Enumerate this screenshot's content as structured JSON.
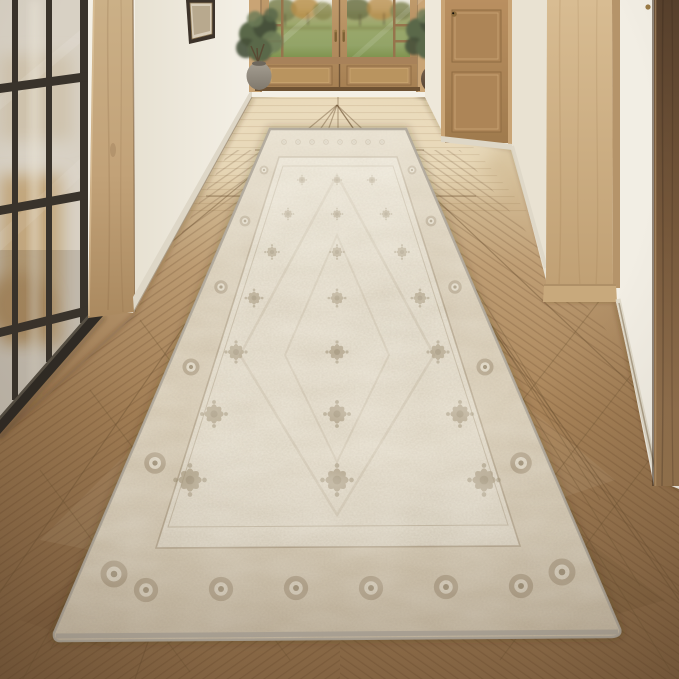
{
  "scene": {
    "aria": "Photograph of a long hallway entryway with a vintage distressed beige runner rug on a chevron oak parquet floor, leading to wooden French doors with a view of a green lawn and autumn trees, flanked by potted olive trees; a black steel-framed frosted glass partition stands on the left and light oak door jambs on the right",
    "subject": "Vintage beige runner rug in hallway",
    "setting": "Interior entry hall, daylight"
  },
  "objects": {
    "rug": "Distressed vintage oriental runner rug, ivory and taupe",
    "doors": "Double wooden French entry doors with glass panes",
    "view": "Green lawn with autumn trees through door glass",
    "plants": "Two potted olive trees flanking the doors",
    "partition": "Black steel-framed frosted glass interior partition",
    "floor": "Chevron oak parquet, lighter near doors, warm brown in foreground",
    "frame": "Small dark picture frame high on left wall",
    "pillar": "Light oak door jamb on right",
    "walnut_door": "Dark walnut door at right edge"
  },
  "colors": {
    "wall": "#f2eee4",
    "wall-shade": "#e7e1d2",
    "endwall": "#f4f0e6",
    "baseboard": "#ded7c7",
    "partition-frame": "#39332b",
    "partition-glass": "#d8d1c4",
    "post-light": "#cbb087",
    "post-dark": "#ab8a60",
    "door-wood-light": "#bf9a6b",
    "door-wood-dark": "#a57f52",
    "door-trim": "#c9a475",
    "landscape-sky": "#eceadf",
    "landscape-trees": "#7e8454",
    "landscape-autumn": "#b98e49",
    "landscape-lawn": "#9aa86b",
    "foliage-dark": "#46513a",
    "foliage-mid": "#5a684a",
    "foliage-light": "#6f7d58",
    "pot-gray": "#9d968a",
    "pot-brown": "#6b5744",
    "mid-door": "#b28a5c",
    "pillar-light": "#d8bc92",
    "pillar-dark": "#c0a074",
    "walnut-dark": "#57402c",
    "walnut-light": "#96754f",
    "floor-far": "#e6d7b8",
    "floor-mid": "#bf9e74",
    "floor-near": "#8f6d49",
    "seam": "#6b5233",
    "rug-field": "#e8e1d1",
    "rug-ivory": "#eae3d3",
    "rug-border": "#d7cbb4",
    "rug-motif": "#a29276",
    "rug-motif-dark": "#877759",
    "rug-binding": "#b1aa9d"
  }
}
